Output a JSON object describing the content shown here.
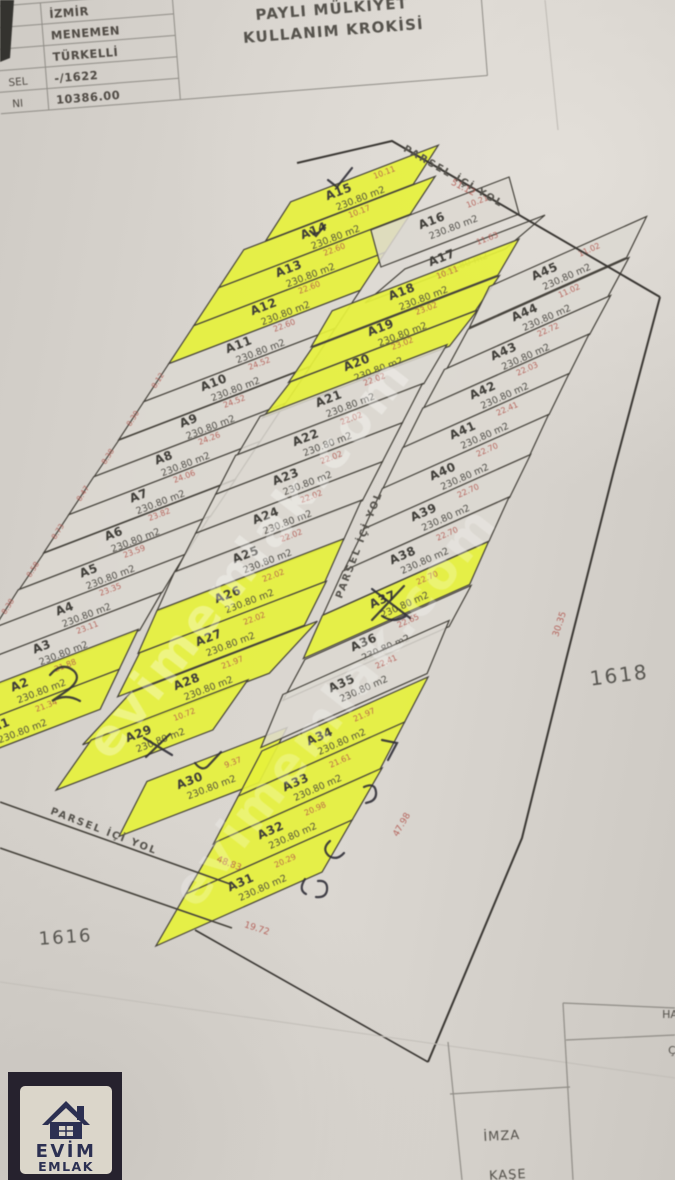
{
  "document": {
    "header_table": {
      "row_labels": [
        "SEL",
        "NI"
      ],
      "rows": [
        "İZMİR",
        "MENEMEN",
        "TÜRKELLİ",
        "-/1622",
        "10386.00"
      ]
    },
    "title": [
      "PAYLI MÜLKİYET",
      "KULLANIM KROKİSİ"
    ]
  },
  "map": {
    "road_label": "PARSEL İÇİ YOL",
    "block_labels": [
      "1618",
      "1616"
    ],
    "area_label": "230.80 m2",
    "edge_dims_left": [
      "8.12",
      "8.30",
      "8.38",
      "8.47",
      "8.73",
      "8.58",
      "8.38",
      "8.30",
      "8.72",
      "9.63",
      "20.38"
    ],
    "standalone_dims": [
      "51.12",
      "48.83",
      "19.72",
      "30.35",
      "47.98"
    ],
    "parcels": [
      {
        "id": "A15",
        "strip": "left",
        "slot": 0,
        "dim": "10.11",
        "highlight": true
      },
      {
        "id": "A14",
        "strip": "left",
        "slot": 1,
        "dim": "10.17",
        "highlight": true
      },
      {
        "id": "A13",
        "strip": "left",
        "slot": 2,
        "dim": "22.60",
        "highlight": true
      },
      {
        "id": "A12",
        "strip": "left",
        "slot": 3,
        "dim": "22.60",
        "highlight": true
      },
      {
        "id": "A11",
        "strip": "left",
        "slot": 4,
        "dim": "22.60",
        "highlight": false
      },
      {
        "id": "A10",
        "strip": "left",
        "slot": 5,
        "dim": "24.52",
        "highlight": false
      },
      {
        "id": "A9",
        "strip": "left",
        "slot": 6,
        "dim": "24.52",
        "highlight": false
      },
      {
        "id": "A8",
        "strip": "left",
        "slot": 7,
        "dim": "24.26",
        "highlight": false
      },
      {
        "id": "A7",
        "strip": "left",
        "slot": 8,
        "dim": "24.06",
        "highlight": false
      },
      {
        "id": "A6",
        "strip": "left",
        "slot": 9,
        "dim": "23.82",
        "highlight": false
      },
      {
        "id": "A5",
        "strip": "left",
        "slot": 10,
        "dim": "23.59",
        "highlight": false
      },
      {
        "id": "A4",
        "strip": "left",
        "slot": 11,
        "dim": "23.35",
        "highlight": false
      },
      {
        "id": "A3",
        "strip": "left",
        "slot": 12,
        "dim": "23.11",
        "highlight": false
      },
      {
        "id": "A2",
        "strip": "left",
        "slot": 13,
        "dim": "21.88",
        "highlight": true
      },
      {
        "id": "A1",
        "strip": "left",
        "slot": 14,
        "dim": "21.34",
        "highlight": true
      },
      {
        "id": "A16",
        "strip": "center",
        "slot": 0,
        "dim": "10.21",
        "highlight": false
      },
      {
        "id": "A17",
        "strip": "center",
        "slot": 1,
        "dim": "11.63",
        "highlight": false
      },
      {
        "id": "A18",
        "strip": "center",
        "slot": 2,
        "dim": "10.11",
        "highlight": true
      },
      {
        "id": "A19",
        "strip": "center",
        "slot": 3,
        "dim": "23.02",
        "highlight": true
      },
      {
        "id": "A20",
        "strip": "center",
        "slot": 4,
        "dim": "23.02",
        "highlight": true
      },
      {
        "id": "A21",
        "strip": "center",
        "slot": 5,
        "dim": "22.02",
        "highlight": false
      },
      {
        "id": "A22",
        "strip": "center",
        "slot": 6,
        "dim": "22.02",
        "highlight": false
      },
      {
        "id": "A23",
        "strip": "center",
        "slot": 7,
        "dim": "22.02",
        "highlight": false
      },
      {
        "id": "A24",
        "strip": "center",
        "slot": 8,
        "dim": "22.02",
        "highlight": false
      },
      {
        "id": "A25",
        "strip": "center",
        "slot": 9,
        "dim": "22.02",
        "highlight": false
      },
      {
        "id": "A26",
        "strip": "center",
        "slot": 10,
        "dim": "22.02",
        "highlight": true
      },
      {
        "id": "A27",
        "strip": "center",
        "slot": 11,
        "dim": "22.02",
        "highlight": true
      },
      {
        "id": "A28",
        "strip": "center",
        "slot": 12,
        "dim": "21.97",
        "highlight": true
      },
      {
        "id": "A29",
        "strip": "center",
        "slot": 13,
        "dim": "10.72",
        "highlight": true
      },
      {
        "id": "A30",
        "strip": "center",
        "slot": 14,
        "dim": "9.37",
        "highlight": true
      },
      {
        "id": "A45",
        "strip": "right",
        "slot": 0,
        "dim": "11.02",
        "highlight": false
      },
      {
        "id": "A44",
        "strip": "right",
        "slot": 1,
        "dim": "11.02",
        "highlight": false
      },
      {
        "id": "A43",
        "strip": "right",
        "slot": 2,
        "dim": "22.72",
        "highlight": false
      },
      {
        "id": "A42",
        "strip": "right",
        "slot": 3,
        "dim": "22.03",
        "highlight": false
      },
      {
        "id": "A41",
        "strip": "right",
        "slot": 4,
        "dim": "22.41",
        "highlight": false
      },
      {
        "id": "A40",
        "strip": "right",
        "slot": 5,
        "dim": "22.70",
        "highlight": false
      },
      {
        "id": "A39",
        "strip": "right",
        "slot": 6,
        "dim": "22.70",
        "highlight": false
      },
      {
        "id": "A38",
        "strip": "right",
        "slot": 7,
        "dim": "22.70",
        "highlight": false
      },
      {
        "id": "A37",
        "strip": "right",
        "slot": 8,
        "dim": "22.70",
        "highlight": true
      },
      {
        "id": "A36",
        "strip": "right",
        "slot": 9,
        "dim": "22.65",
        "highlight": false
      },
      {
        "id": "A35",
        "strip": "right",
        "slot": 10,
        "dim": "22.41",
        "highlight": false
      },
      {
        "id": "A34",
        "strip": "right",
        "slot": 11,
        "dim": "21.97",
        "highlight": true
      },
      {
        "id": "A33",
        "strip": "right",
        "slot": 12,
        "dim": "21.61",
        "highlight": true
      },
      {
        "id": "A32",
        "strip": "right",
        "slot": 13,
        "dim": "20.98",
        "highlight": true
      },
      {
        "id": "A31",
        "strip": "right",
        "slot": 14,
        "dim": "20.29",
        "highlight": true
      }
    ],
    "colors": {
      "highlight": "#e6f13c",
      "paper_parcel": "#dcd8d1",
      "line": "#44413a",
      "red": "#b0524a",
      "ink": "#3f3d38",
      "ink_soft": "#55524c"
    }
  },
  "stamp_table": {
    "labels": [
      "İMZA",
      "KAŞE"
    ],
    "fragments": [
      "HA",
      "Ç"
    ]
  },
  "watermark": {
    "text": "evimemlak.com"
  },
  "logo": {
    "line1": "EVİM",
    "line2": "EMLAK"
  }
}
